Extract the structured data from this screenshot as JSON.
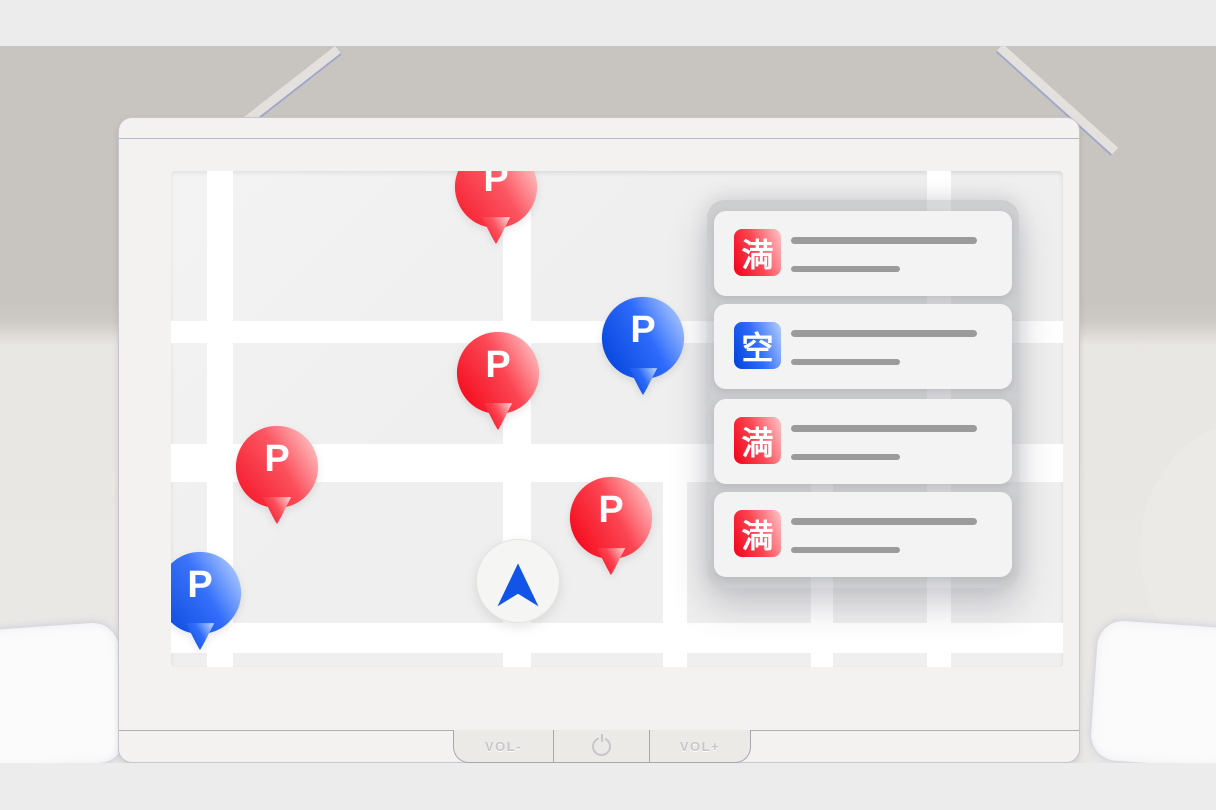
{
  "screen": {
    "map": {
      "pins": [
        {
          "label": "P",
          "status": "full",
          "position": "top-center"
        },
        {
          "label": "P",
          "status": "full",
          "position": "middle-center"
        },
        {
          "label": "P",
          "status": "vacant",
          "position": "middle-right"
        },
        {
          "label": "P",
          "status": "full",
          "position": "middle-left"
        },
        {
          "label": "P",
          "status": "full",
          "position": "lower-center"
        },
        {
          "label": "P",
          "status": "vacant",
          "position": "bottom-left"
        }
      ],
      "location_marker": {
        "icon": "navigation-arrow-icon",
        "arrow_color": "#1253e8"
      }
    },
    "panel": {
      "cards": [
        {
          "badge": "満",
          "badge_style": "red",
          "placeholder_lines": 2
        },
        {
          "badge": "空",
          "badge_style": "blue",
          "placeholder_lines": 2
        },
        {
          "badge": "満",
          "badge_style": "red",
          "placeholder_lines": 2
        },
        {
          "badge": "満",
          "badge_style": "red",
          "placeholder_lines": 2
        }
      ]
    }
  },
  "device": {
    "buttons": [
      {
        "label": "VOL-"
      },
      {
        "label": "",
        "icon": "power-icon"
      },
      {
        "label": "VOL+"
      }
    ]
  },
  "colors": {
    "pin_red_start": "#f50a1d",
    "pin_red_end": "#ffc2c4",
    "pin_blue_start": "#0646dc",
    "pin_blue_end": "#aecbff",
    "badge_red": "#f2081f",
    "badge_blue": "#0747e0",
    "map_background": "#efefef",
    "road": "#ffffff",
    "card_background": "#f3f3f3",
    "placeholder_line": "#9b9b9b",
    "arrow_blue": "#1253e8"
  }
}
